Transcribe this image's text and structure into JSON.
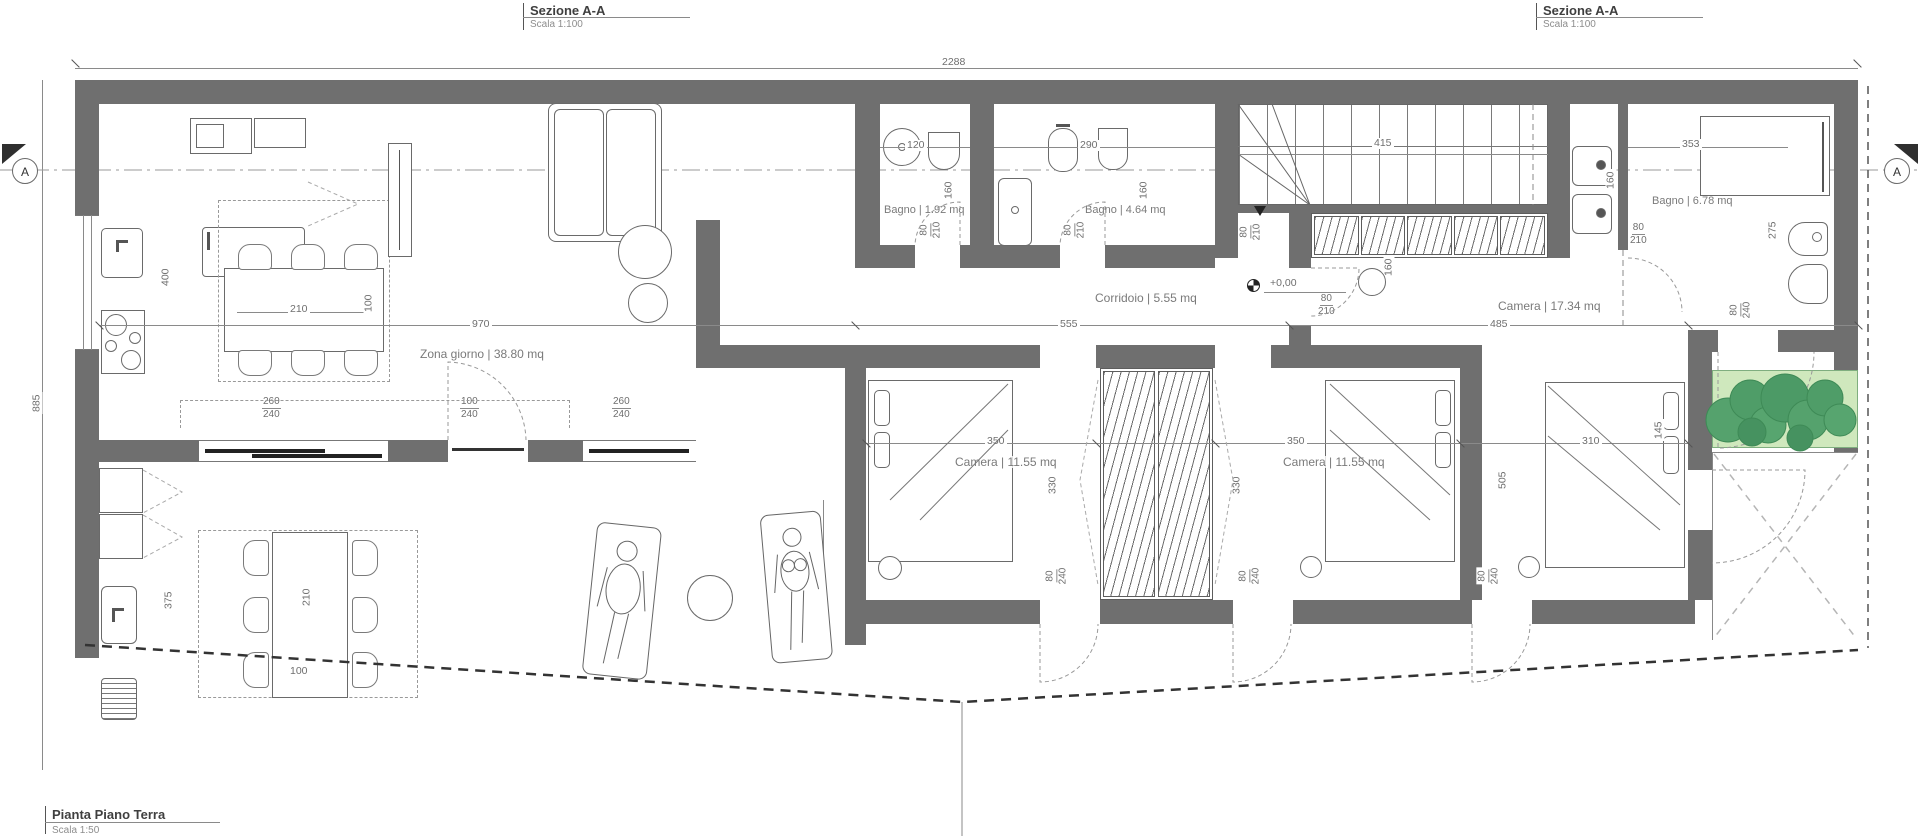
{
  "colors": {
    "wall": "#6f6f6f",
    "tree_green": "#4f9d6b",
    "planter_green": "#cfe8bd"
  },
  "titles": {
    "section_left": {
      "title": "Sezione A-A",
      "scale": "Scala 1:100"
    },
    "section_right": {
      "title": "Sezione A-A",
      "scale": "Scala 1:100"
    },
    "plan": {
      "title": "Pianta Piano Terra",
      "scale": "Scala 1:50"
    }
  },
  "markers": {
    "section": "A",
    "level": "+0,00"
  },
  "rooms": {
    "living": "Zona giorno | 38.80 mq",
    "bath_small": "Bagno | 1.92 mq",
    "bath_mid": "Bagno | 4.64 mq",
    "bath_large": "Bagno | 6.78 mq",
    "corridor": "Corridoio | 5.55 mq",
    "bedroom_large": "Camera | 17.34 mq",
    "bedroom_1": "Camera | 11.55 mq",
    "bedroom_2": "Camera | 11.55 mq"
  },
  "dims": {
    "total_width": "2288",
    "total_depth": "885",
    "living_width": "970",
    "corridor_length": "555",
    "bedroom_large_width": "485",
    "stair_run": "415",
    "bath_large_width": "353",
    "bath_large_depth": "275",
    "kitchen_depth": "400",
    "table_length": "210",
    "table_width": "100",
    "bath_small_width": "120",
    "bath_mid_width": "290",
    "niche_a": "160",
    "niche_b": "160",
    "niche_c": "160",
    "niche_d": "160",
    "outdoor_side": "375",
    "outdoor_table_length": "210",
    "outdoor_table_width": "100",
    "terrace_depth": "220",
    "bed1_width": "350",
    "bed2_width": "350",
    "bed3_width": "310",
    "bed1_depth": "330",
    "bed2_depth": "330",
    "bed3_depth": "505",
    "bed3_side": "145"
  },
  "openings": [
    {
      "w": "260",
      "h": "240"
    },
    {
      "w": "100",
      "h": "240"
    },
    {
      "w": "260",
      "h": "240"
    }
  ],
  "doors_small": [
    {
      "w": "80",
      "h": "210"
    },
    {
      "w": "80",
      "h": "210"
    },
    {
      "w": "80",
      "h": "210"
    },
    {
      "w": "80",
      "h": "210"
    },
    {
      "w": "80",
      "h": "210"
    }
  ],
  "doors_tall": [
    {
      "w": "80",
      "h": "240"
    },
    {
      "w": "80",
      "h": "240"
    },
    {
      "w": "80",
      "h": "240"
    },
    {
      "w": "80",
      "h": "240"
    }
  ]
}
